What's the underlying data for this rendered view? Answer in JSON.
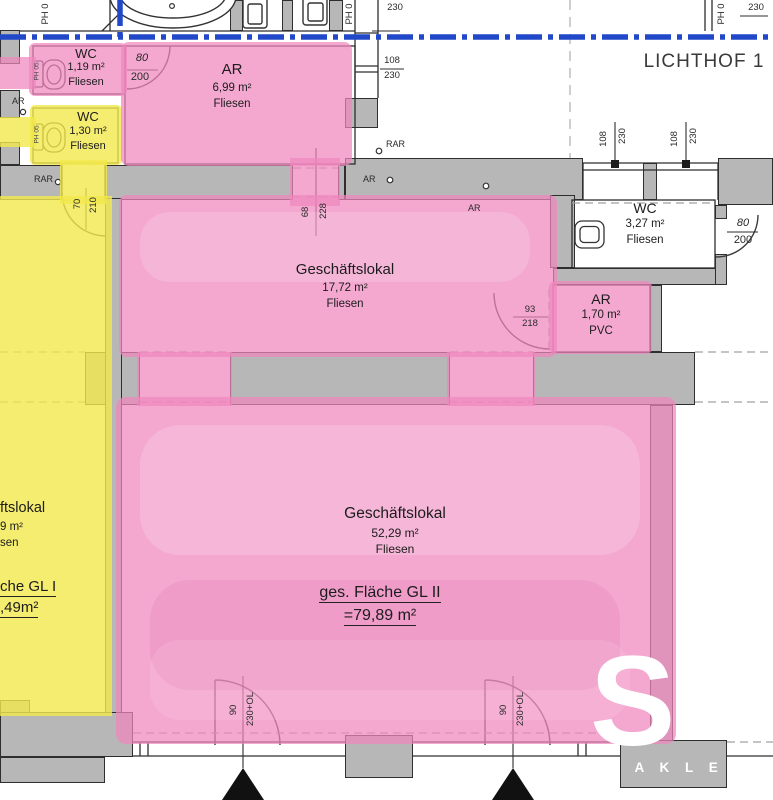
{
  "plan": {
    "lichthof_label": "LICHTHOF 1",
    "rooms": {
      "wc119": {
        "name": "WC",
        "area": "1,19 m²",
        "floor": "Fliesen"
      },
      "wc130": {
        "name": "WC",
        "area": "1,30 m²",
        "floor": "Fliesen"
      },
      "ar699": {
        "name": "AR",
        "area": "6,99 m²",
        "floor": "Fliesen"
      },
      "gl1772": {
        "name": "Geschäftslokal",
        "area": "17,72 m²",
        "floor": "Fliesen"
      },
      "wc327": {
        "name": "WC",
        "area": "3,27 m²",
        "floor": "Fliesen"
      },
      "ar170": {
        "name": "AR",
        "area": "1,70 m²",
        "floor": "PVC"
      },
      "gl5229": {
        "name": "Geschäftslokal",
        "area": "52,29 m²",
        "floor": "Fliesen"
      },
      "gl1": {
        "name_fragment": "ftslokal",
        "area_fragment": "9 m²",
        "floor_fragment": "sen"
      }
    },
    "totals": {
      "gl2_label": "ges. Fläche GL II",
      "gl2_value": "=79,89 m²",
      "gl1_label_fragment": "che GL I",
      "gl1_value_fragment": ",49m²"
    },
    "dims": {
      "w80": "80",
      "w200": "200",
      "w108": "108",
      "w230": "230",
      "w70": "70",
      "w210": "210",
      "w68": "68",
      "w228": "228",
      "w93": "93",
      "w218": "218",
      "w90": "90",
      "w230ol": "230+OL",
      "ph0": "PH 0",
      "ph05": "PH 05"
    },
    "annotations": {
      "ar": "AR",
      "rar": "RAR"
    },
    "watermark": {
      "letter": "S",
      "name_fragment": "M A K L E"
    },
    "colors": {
      "highlight_pink": "#f086be",
      "highlight_yellow": "#f3e94c",
      "wall_gray": "#b7b7b7",
      "boundary_blue": "#2148c8"
    }
  }
}
